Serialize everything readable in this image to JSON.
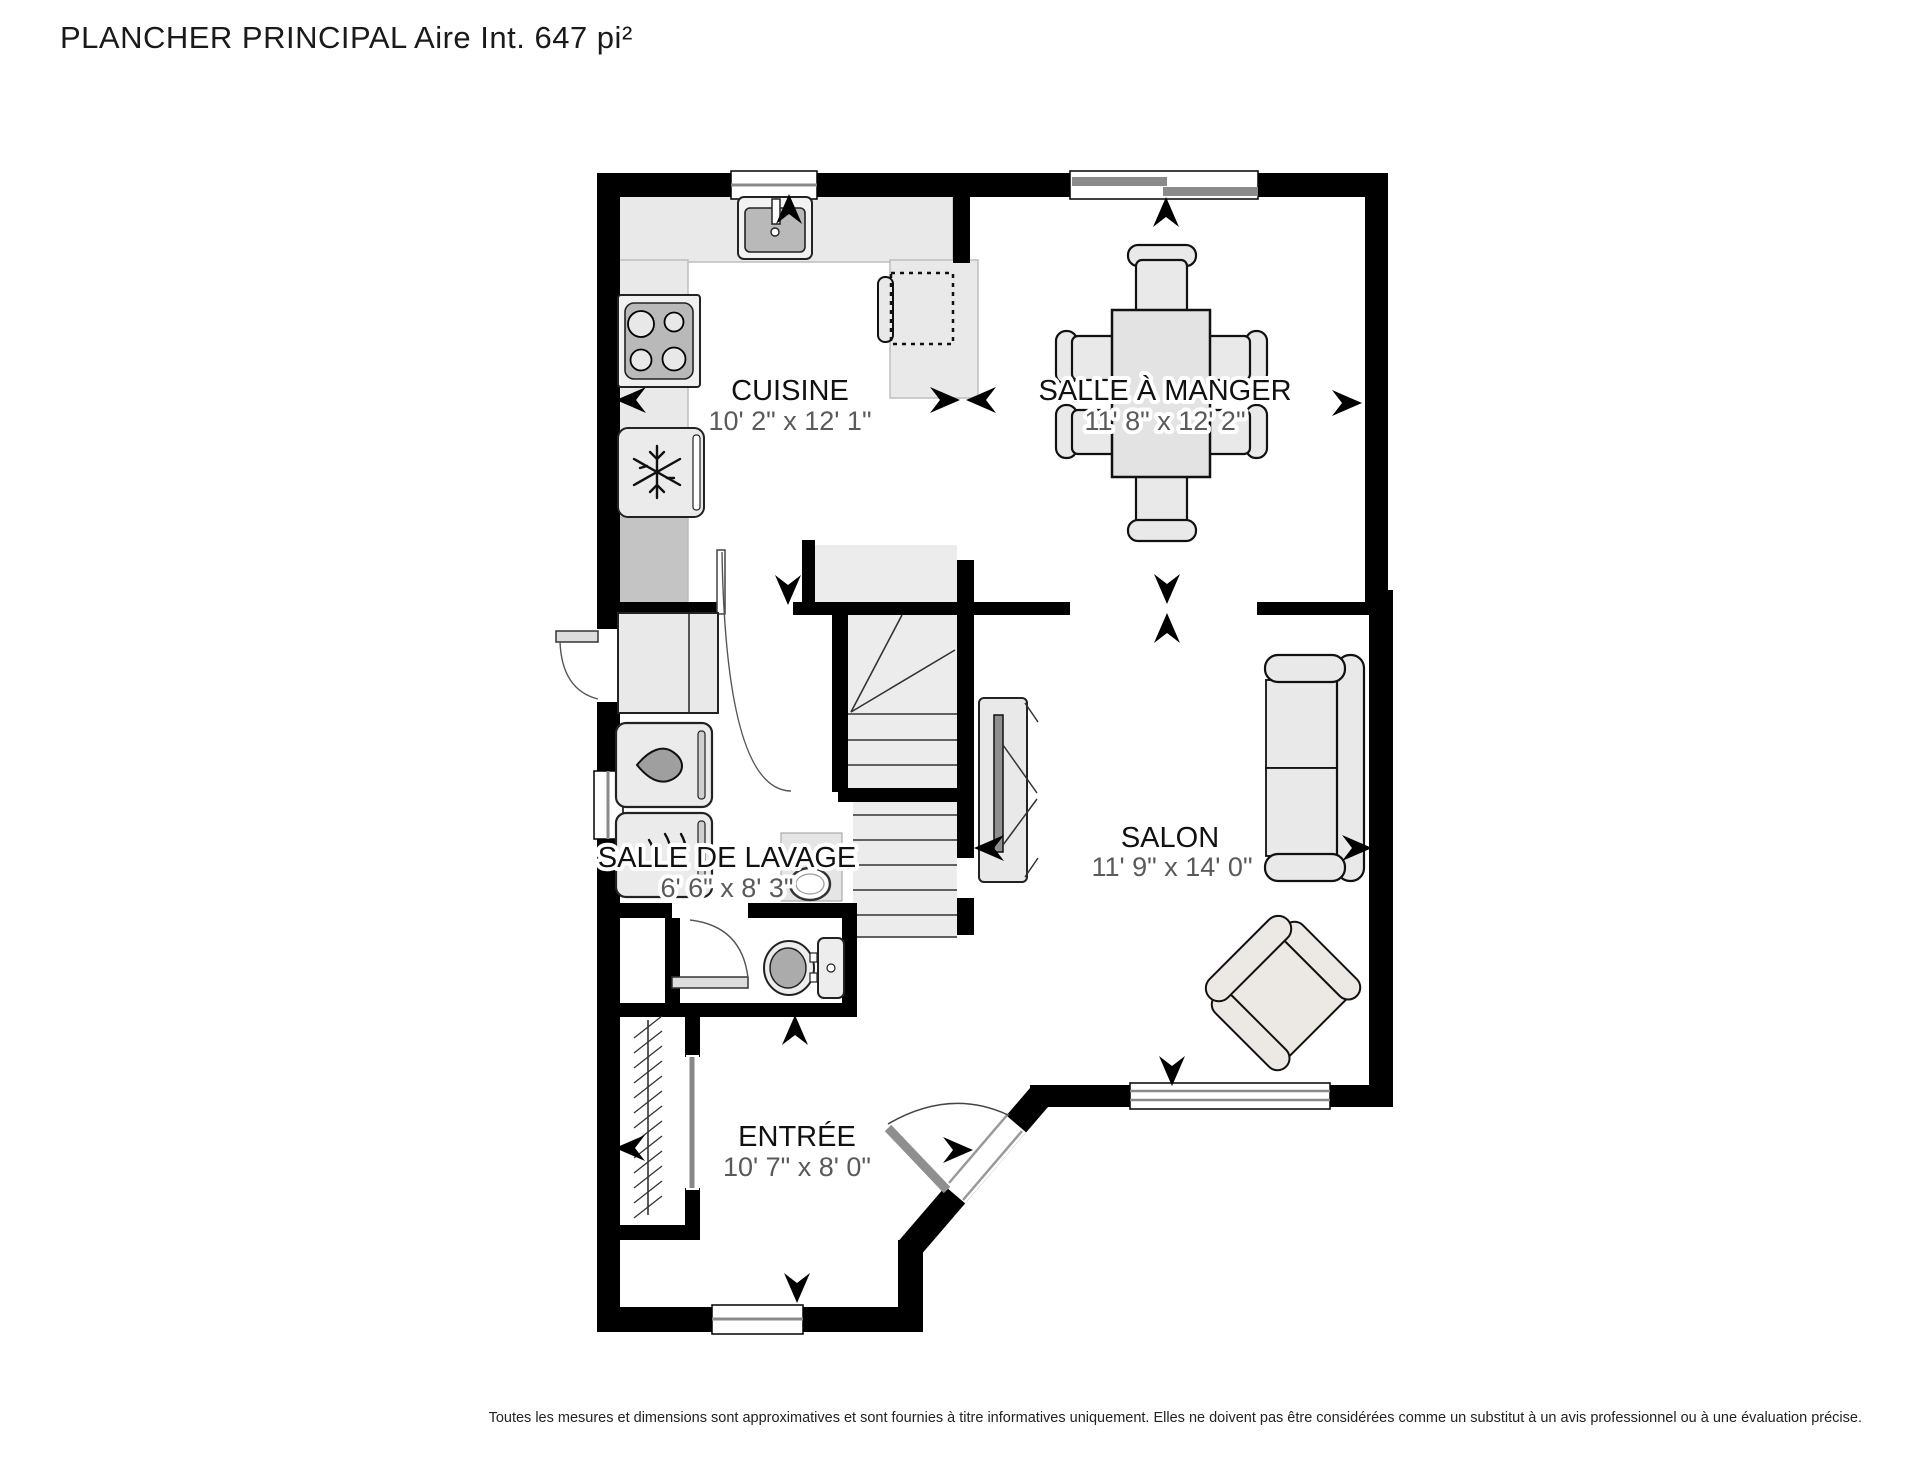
{
  "title": "PLANCHER PRINCIPAL Aire Int. 647 pi²",
  "disclaimer": "Toutes les mesures et dimensions sont approximatives et sont fournies à titre informatives uniquement. Elles ne doivent pas être considérées comme un substitut à un avis professionnel ou à une évaluation précise.",
  "rooms": [
    {
      "id": "cuisine",
      "label": "CUISINE",
      "dimensions": "10' 2\" x 12' 1\""
    },
    {
      "id": "salle_a_manger",
      "label": "SALLE À MANGER",
      "dimensions": "11' 8\" x 12' 2\""
    },
    {
      "id": "salle_de_lavage",
      "label": "SALLE DE LAVAGE",
      "dimensions": "6' 6\" x 8' 3\""
    },
    {
      "id": "salon",
      "label": "SALON",
      "dimensions": "11' 9\" x 14' 0\""
    },
    {
      "id": "entree",
      "label": "ENTRÉE",
      "dimensions": "10' 7\" x 8' 0\""
    }
  ],
  "fixtures": [
    "kitchen-sink",
    "stove",
    "refrigerator",
    "bar-stool",
    "dining-table",
    "dining-chair",
    "sofa",
    "armchair",
    "tv-unit",
    "laundry-cabinet",
    "washer",
    "dryer",
    "laundry-sink",
    "toilet",
    "stairs",
    "closet-rod",
    "entry-door",
    "side-door",
    "interior-door",
    "window",
    "direction-arrow"
  ],
  "colors": {
    "wall": "#000000",
    "furniture": "#e9e9e9",
    "appliance_inner": "#b9b9b9",
    "counter_dark": "#c4c4c4",
    "label_text": "#111111",
    "dimension_text": "#5a5a5a",
    "window_bar": "#8a8a8a"
  }
}
